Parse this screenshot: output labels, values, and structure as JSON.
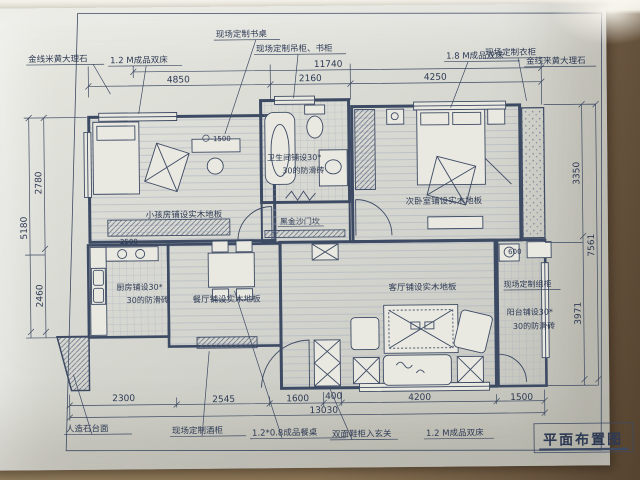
{
  "title": {
    "text": "平面布置图"
  },
  "top": {
    "marble_left": "金线米黄大理石",
    "bed_left": "1.2 M成品双床",
    "desk": "现场定制书桌",
    "bookcase": "现场定制吊柜、书柜",
    "wardrobe": "现场定制衣柜",
    "bed_right": "1.8 M成品双床",
    "marble_right": "金线米黄大理石"
  },
  "rooms": {
    "child": "小孩房铺设实木地板",
    "bath_1": "卫生间铺设30*",
    "bath_2": "30的防滑砖",
    "threshold": "黑金沙门坎",
    "bedroom": "次卧室铺设实木地板",
    "kitchen_1": "厨房铺设30*",
    "kitchen_2": "30的防滑砖",
    "dining": "餐厅铺设实木地板",
    "living": "客厅铺设实木地板",
    "cabinet_right": "现场定制组柜",
    "balcony_1": "阳台铺设30*",
    "balcony_2": "30的防滑砖"
  },
  "bottom": {
    "counter": "人造石台面",
    "wine_cabinet": "现场定制酒柜",
    "dining_table": "1.2*0.8成品餐桌",
    "shoe_cabinet": "双面鞋柜入玄关",
    "bed": "1.2 M成品双床"
  },
  "dims": {
    "top_total": "11740",
    "seg_left": "4850",
    "seg_mid": "2160",
    "seg_right": "4250",
    "left_total": "5180",
    "left_up": "2780",
    "left_low": "2460",
    "right_total": "7561",
    "right_up": "3350",
    "right_low": "3971",
    "b1": "2300",
    "b2": "2545",
    "b3": "1600",
    "b4": "400",
    "b5": "4200",
    "b6": "1500",
    "bottom_total": "13030",
    "desk": "1500",
    "wardrobe": "2500",
    "balcony": "600"
  }
}
